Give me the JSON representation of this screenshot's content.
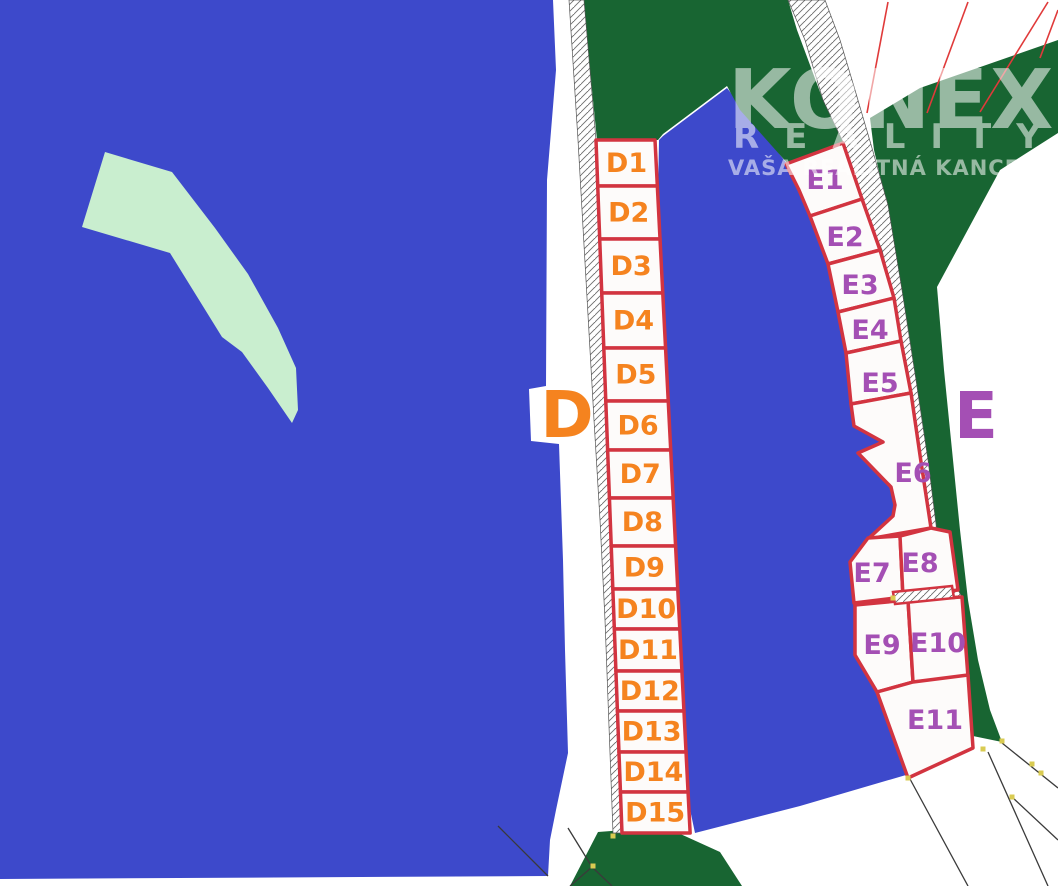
{
  "watermark": {
    "brand": "KONEX",
    "tagline": "REALITY",
    "subtitle": "VAŠA REALITNÁ KANCELÁRIA"
  },
  "zones": {
    "d": {
      "letter": "D",
      "color": "#F5831F",
      "plot_labels": [
        "D1",
        "D2",
        "D3",
        "D4",
        "D5",
        "D6",
        "D7",
        "D8",
        "D9",
        "D10",
        "D11",
        "D12",
        "D13",
        "D14",
        "D15"
      ]
    },
    "e": {
      "letter": "E",
      "color": "#A44FB4",
      "plot_labels": [
        "E1",
        "E2",
        "E3",
        "E4",
        "E5",
        "E6",
        "E7",
        "E8",
        "E9",
        "E10",
        "E11"
      ]
    }
  },
  "colors": {
    "field_blue": "#3D49CB",
    "forest_green": "#186532",
    "meadow_green": "#C9EECF",
    "plot_fill": "#FDFBFA",
    "plot_border": "#D23440",
    "red_boundary": "#E03A3A",
    "black_boundary": "#3A3A3A",
    "survey_marker": "#D9CB52",
    "road_fill": "#FFFFFF",
    "hatch_line": "#6E6E6E",
    "watermark_white": "#FFFFFF"
  }
}
